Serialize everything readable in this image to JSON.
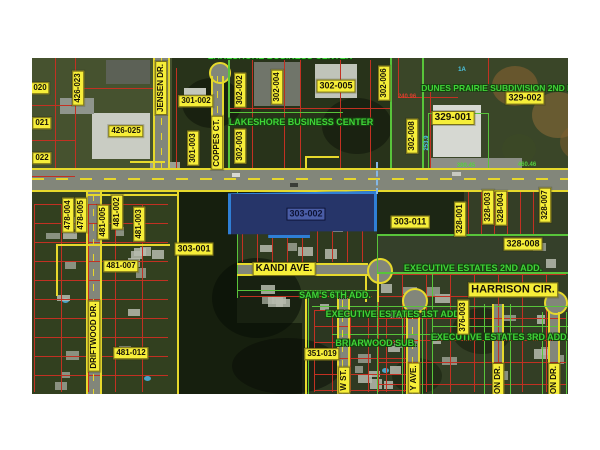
{
  "map": {
    "selected_parcel": {
      "id": "303-002",
      "fill": "#263569",
      "border": "#2f7fd6"
    },
    "parcel_labels": [
      "020",
      "021",
      "022",
      "426-023",
      "426-025",
      "301-002",
      "301-003",
      "302-002",
      "302-003",
      "302-004",
      "302-005",
      "302-006",
      "302-008",
      "329-001",
      "329-002",
      "478-004",
      "478-005",
      "481-005",
      "481-002",
      "481-003",
      "481-007",
      "481-012",
      "303-001",
      "303-011",
      "328-001",
      "328-003",
      "328-004",
      "328-007",
      "328-008",
      "351-019",
      "376-003"
    ],
    "road_labels": [
      "JENSEN DR.",
      "COPPES CT.",
      "DRIFTWOOD DR.",
      "KANDI AVE.",
      "HARRISON CIR.",
      "W ST.",
      "Y AVE.",
      "ON DR.",
      "ON DR."
    ],
    "subdivision_labels": [
      "LAKESHORE BUSINESS CENTER",
      "LAKESHORE BUSINESS CENTER",
      "DUNES PRAIRIE SUBDIVISION 2ND P",
      "EXECUTIVE ESTATES 2ND ADD.",
      "SAM'S 6TH ADD.",
      "EXECUTIVE ESTATES 1ST ADD.",
      "BRIARWOOD SUB.",
      "EXECUTIVE ESTATES 3RD ADD."
    ],
    "small_texts": [
      "1A",
      "240.96",
      "253.9",
      "300.45",
      "460.46"
    ],
    "colors": {
      "label_background": "#f6ee39",
      "subdivision_text": "#3fd437",
      "block_boundary": "#e6d92c",
      "lot_line": "#c23122",
      "subdivision_line": "#58c43a",
      "selection_blue": "#2f7fd6"
    }
  }
}
